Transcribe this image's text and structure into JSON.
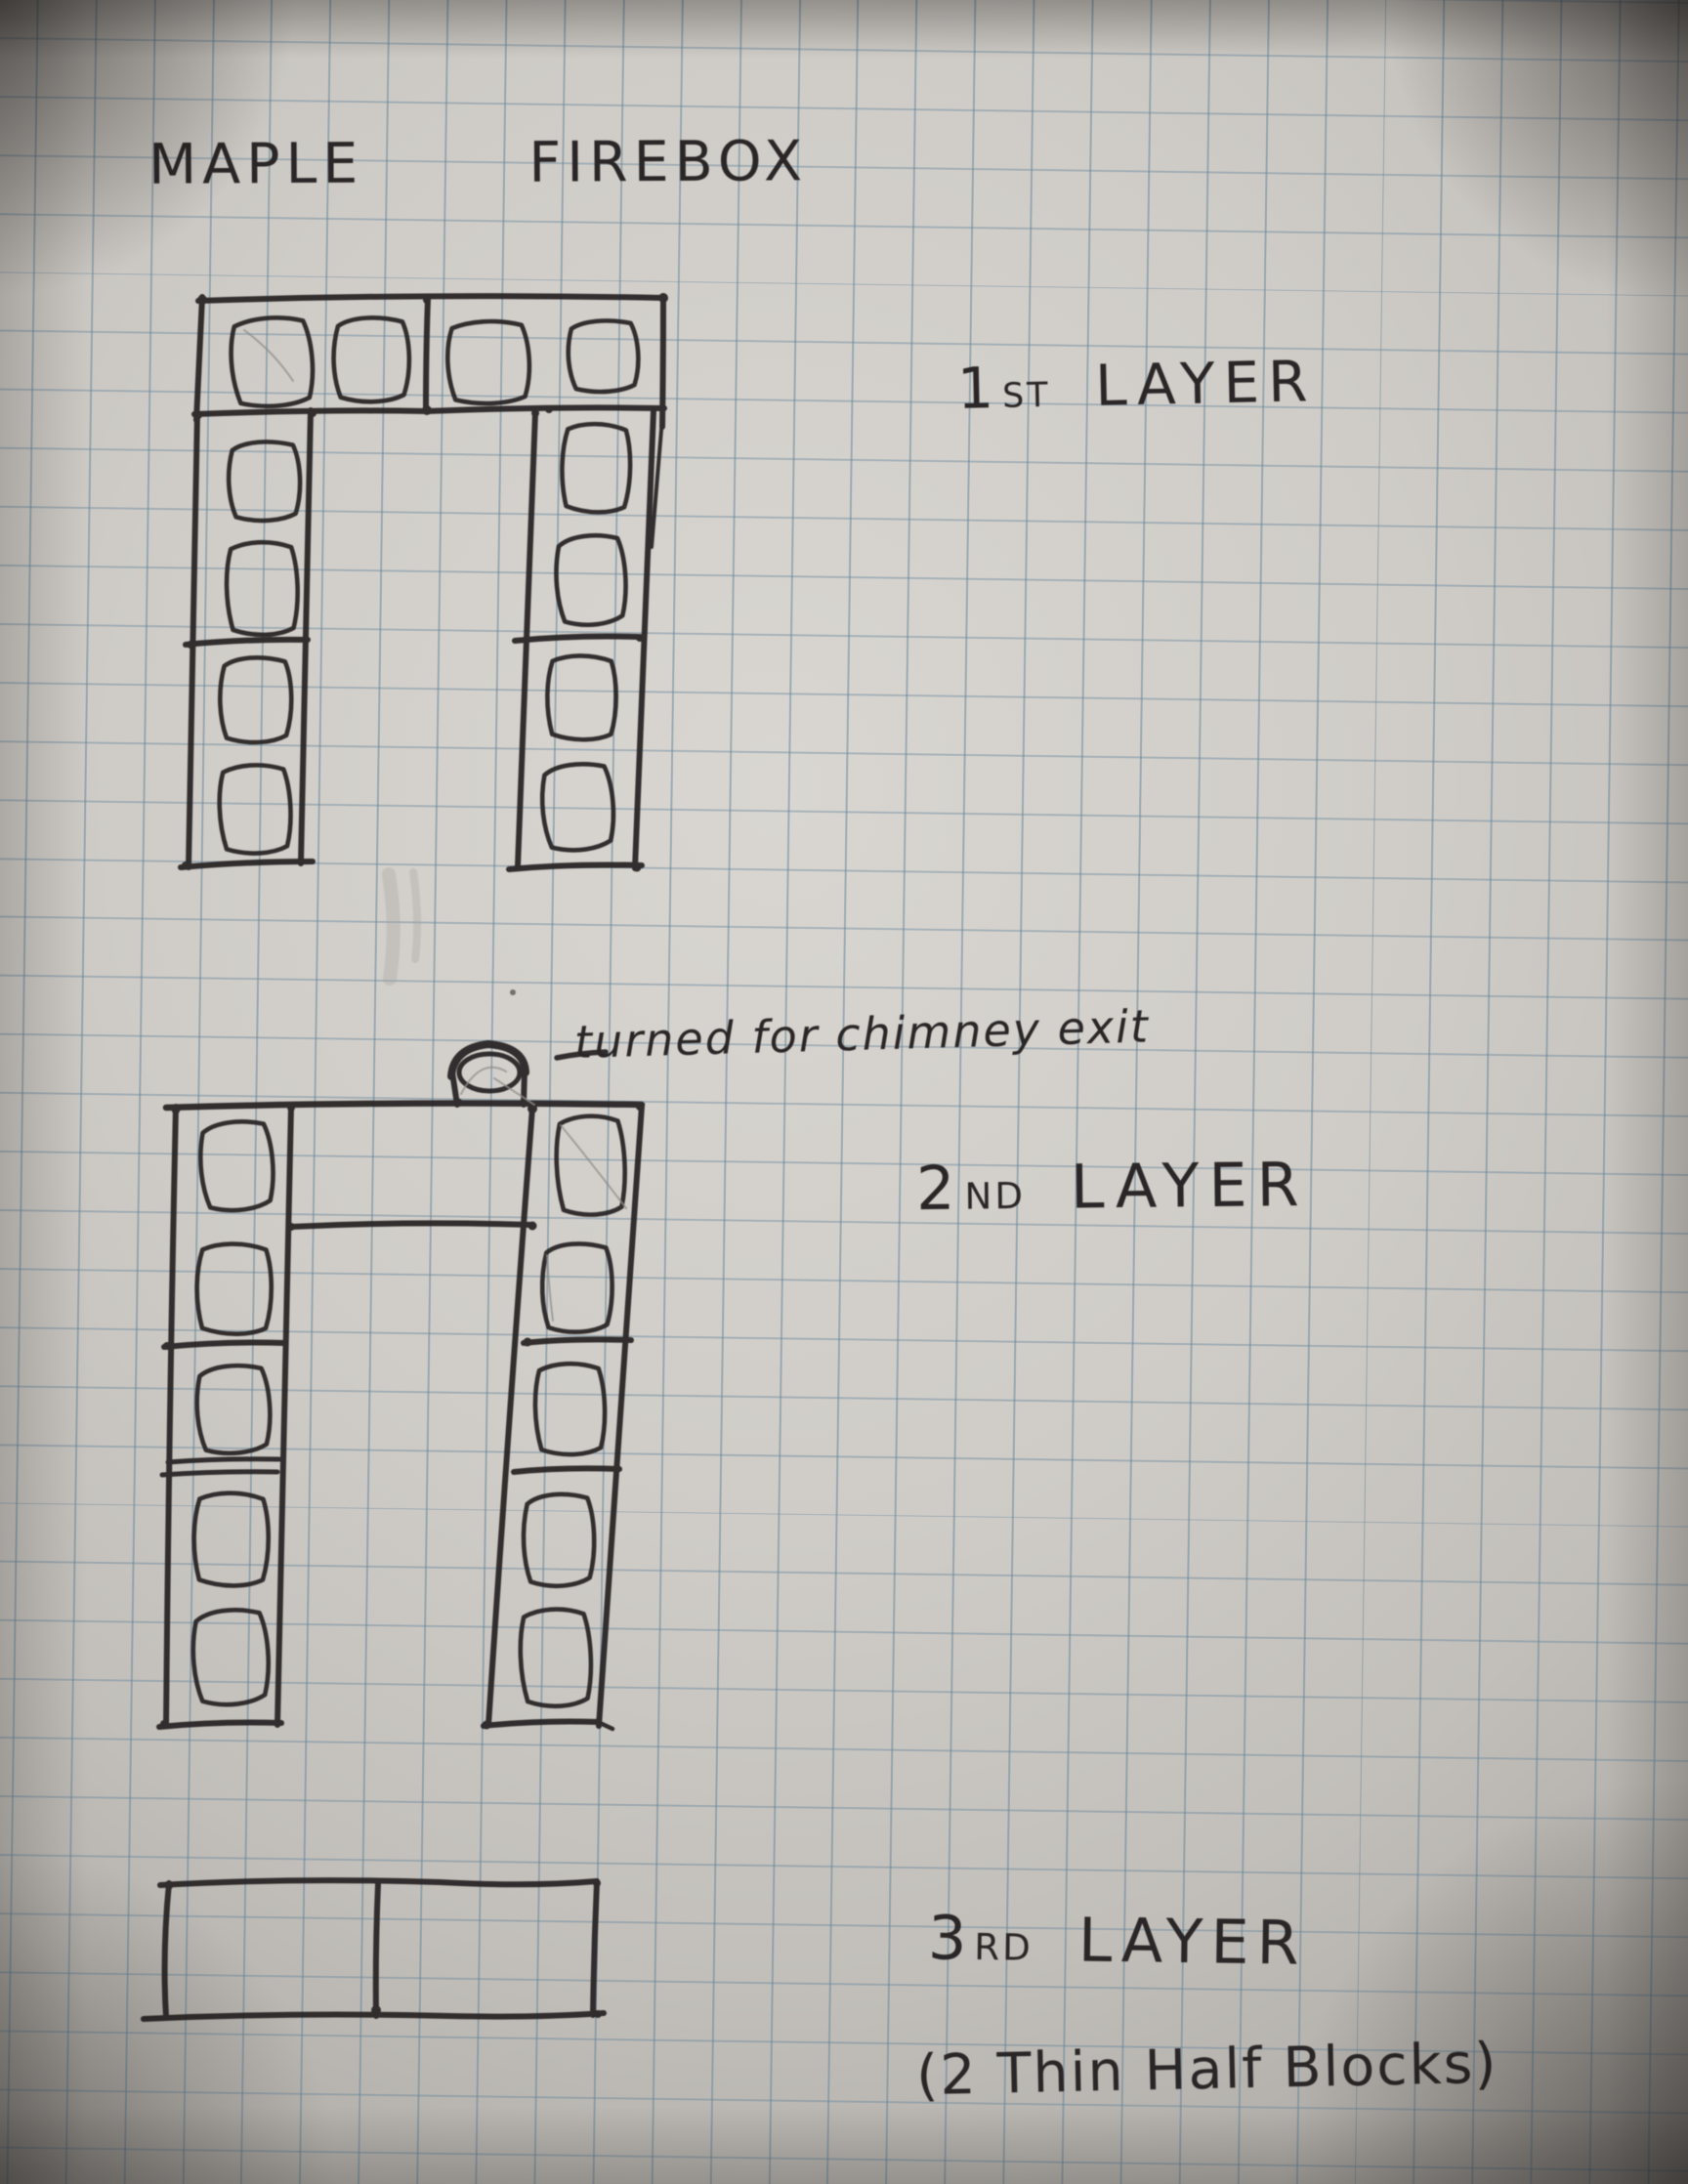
{
  "photo": {
    "description": "Hand-drawn pen sketch on blue graph paper of cinder-block firebox layer plans",
    "title": "MAPLE FIREBOX"
  },
  "layers": {
    "first": {
      "ordinal": "1",
      "suffix": "ST",
      "word": "LAYER",
      "structure": {
        "top_row_blocks": 2,
        "left_column_blocks": 2,
        "right_column_blocks": 2,
        "holes_per_block": 2
      }
    },
    "second": {
      "ordinal": "2",
      "suffix": "ND",
      "word": "LAYER",
      "annotation": {
        "dash": "—",
        "text": "turned for chimney exit"
      },
      "structure": {
        "left_column_blocks": 3,
        "right_column_blocks": 3,
        "half_blocks_per_column": 1,
        "chimney_exit_blocks": 1
      }
    },
    "third": {
      "ordinal": "3",
      "suffix": "RD",
      "word": "LAYER",
      "note": "(2 Thin Half Blocks)",
      "structure": {
        "blocks": 2
      }
    }
  },
  "colors": {
    "paper": "#cfccc7",
    "grid_line": "#64849a",
    "ink": "#2a2526",
    "pencil": "#8f8b87"
  }
}
